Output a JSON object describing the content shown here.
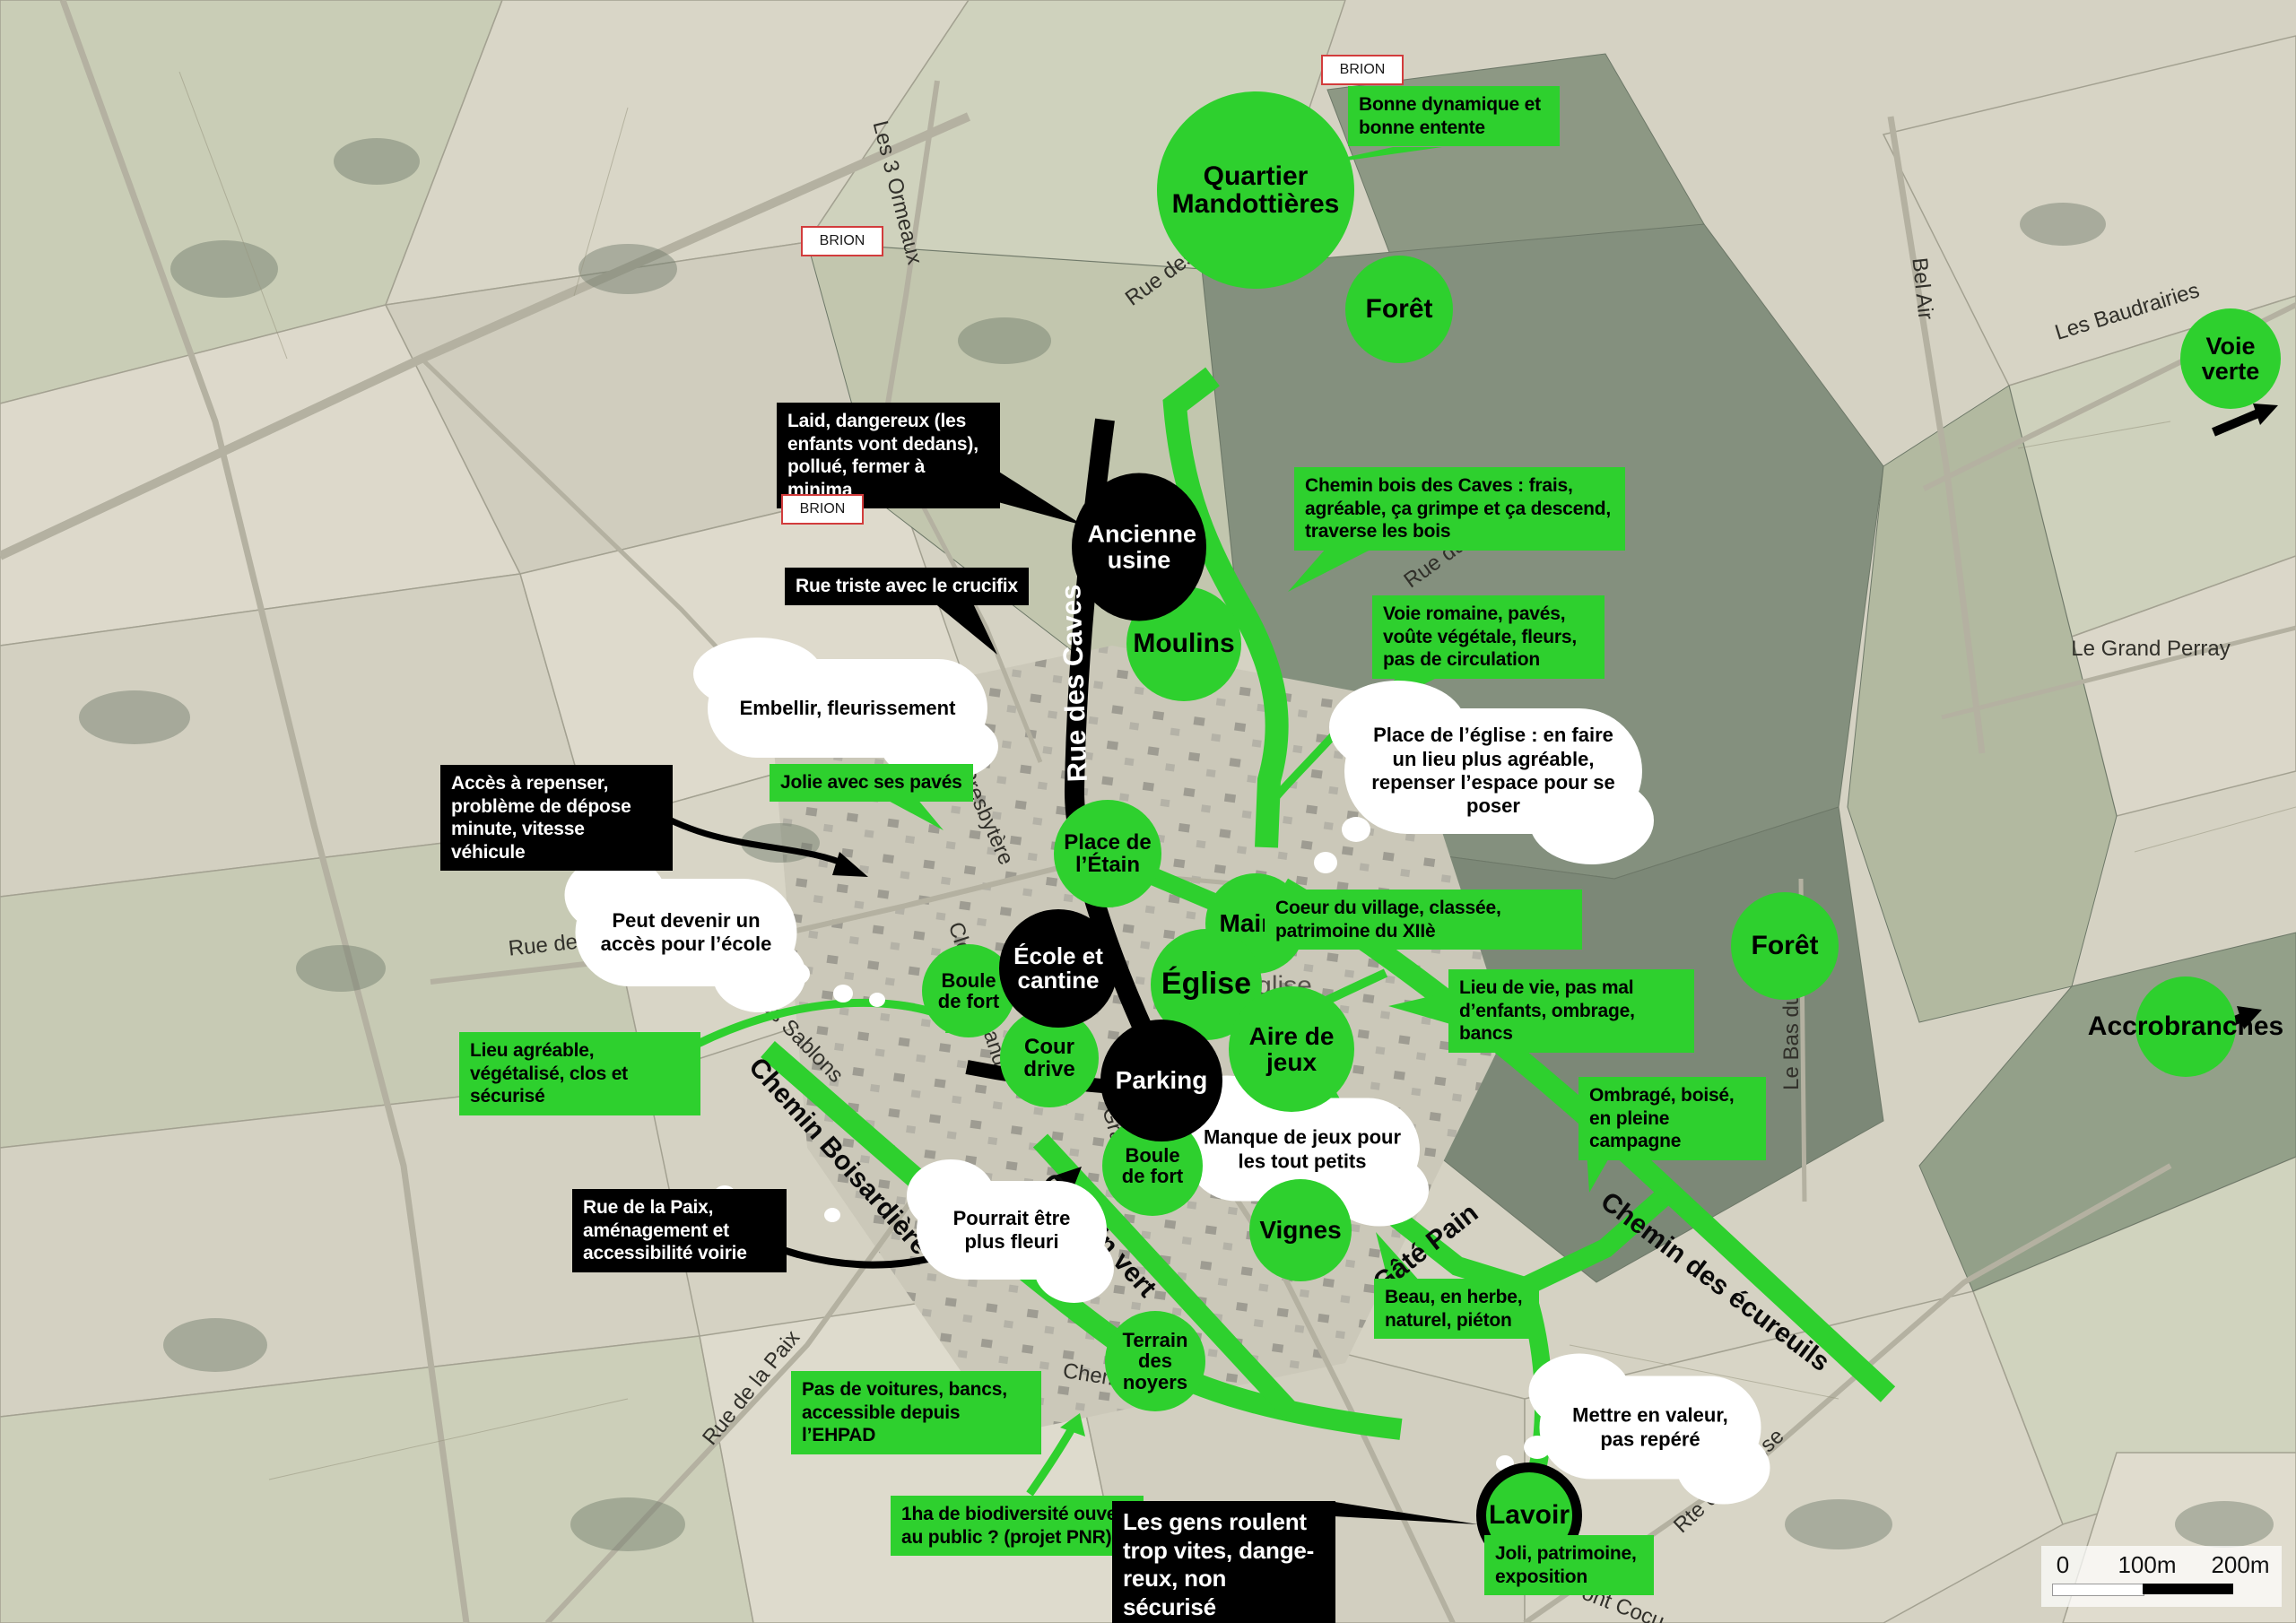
{
  "map_overlay": {
    "commune_label": "BRION",
    "scale_bar": {
      "ticks": [
        "0",
        "100m",
        "200m"
      ]
    },
    "colors": {
      "annotation_green": "#2ed02e",
      "annotation_black": "#000000",
      "cloud_white": "#ffffff",
      "brion_border_red": "#d23c3c"
    }
  },
  "places_green": [
    "Quartier Mandottières",
    "Forêt",
    "Voie verte",
    "Moulins",
    "Place de l’Étain",
    "Mairie",
    "Église",
    "Boule de fort",
    "Cour drive",
    "Aire de jeux",
    "Boule de fort",
    "Vignes",
    "Forêt",
    "Accrobranches",
    "Terrain des noyers",
    "Lavoir"
  ],
  "places_black": [
    "Ancienne usine",
    "École et cantine",
    "Parking"
  ],
  "green_notes": [
    "Bonne dynamique et bonne entente",
    "Chemin bois des Caves : frais, agréable, ça grimpe et ça descend, traverse les bois",
    "Voie romaine, pavés, voûte végétale, fleurs, pas de circulation",
    "Jolie avec ses pavés",
    "Coeur du village, classée, patrimoine du XIIè",
    "Lieu de vie, pas mal d’enfants, ombrage, bancs",
    "Lieu agréable, végétalisé, clos et sécurisé",
    "Ombragé, boisé, en pleine campagne",
    "Beau, en herbe, naturel, piéton",
    "Pas de voitures, bancs, accessible depuis l’EHPAD",
    "1ha de biodiversité ouvert au public ? (projet PNR)",
    "Joli, patrimoine, exposition"
  ],
  "black_notes": [
    "Laid, dangereux (les enfants vont dedans), pollué, fermer à minima",
    "Rue triste avec le crucifix",
    "Accès à repenser, problème de dépose minute, vitesse véhicule",
    "Rue de la Paix, aménagement et accessibilité voirie",
    "Les gens roulent trop vites, dange-reux, non sécurisé"
  ],
  "white_notes": [
    "Embellir, fleurissement",
    "Peut devenir un accès pour l’école",
    "Place de l’église : en faire un lieu plus agréable, repenser l’espace pour se poser",
    "Manque de jeux pour les tout petits",
    "Pourrait être plus fleuri",
    "Mettre en valeur, pas repéré"
  ],
  "street_labels": {
    "les_3_ormeaux": "Les 3 Ormeaux",
    "rue_des_m": "Rue des M",
    "bel_air": "Bel Air",
    "les_baudrairies": "Les Baudrairies",
    "le_grand_perray": "Le Grand Perray",
    "rue_du": "Rue du",
    "rue_des_caves": "Rue des Caves",
    "le_bas_du_tertre": "Le Bas du Tertre",
    "rue_de_l_uni": "Rue de l’Uni",
    "rue_des_sablons": "Rue des Sablons",
    "rue_du_presbytere": "Rue du Presbytère",
    "clos_de_la_lande": "Clos de la Lande",
    "grand_rue": "Grand Rue",
    "chemin_de_la": "Chemin de la",
    "rue_de_la_paix": "Rue de la Paix",
    "rte_de_la_brise": "Rte de la Brise",
    "pont_cocu": "Pont Cocu",
    "gate_pain": "Gâté Pain",
    "chemin_vert": "Chemin vert",
    "chemin_boisardiere": "Chemin Boisardière",
    "chemin_des_ecureuils": "Chemin des écureuils",
    "eglise_map_fragment": "glise"
  }
}
